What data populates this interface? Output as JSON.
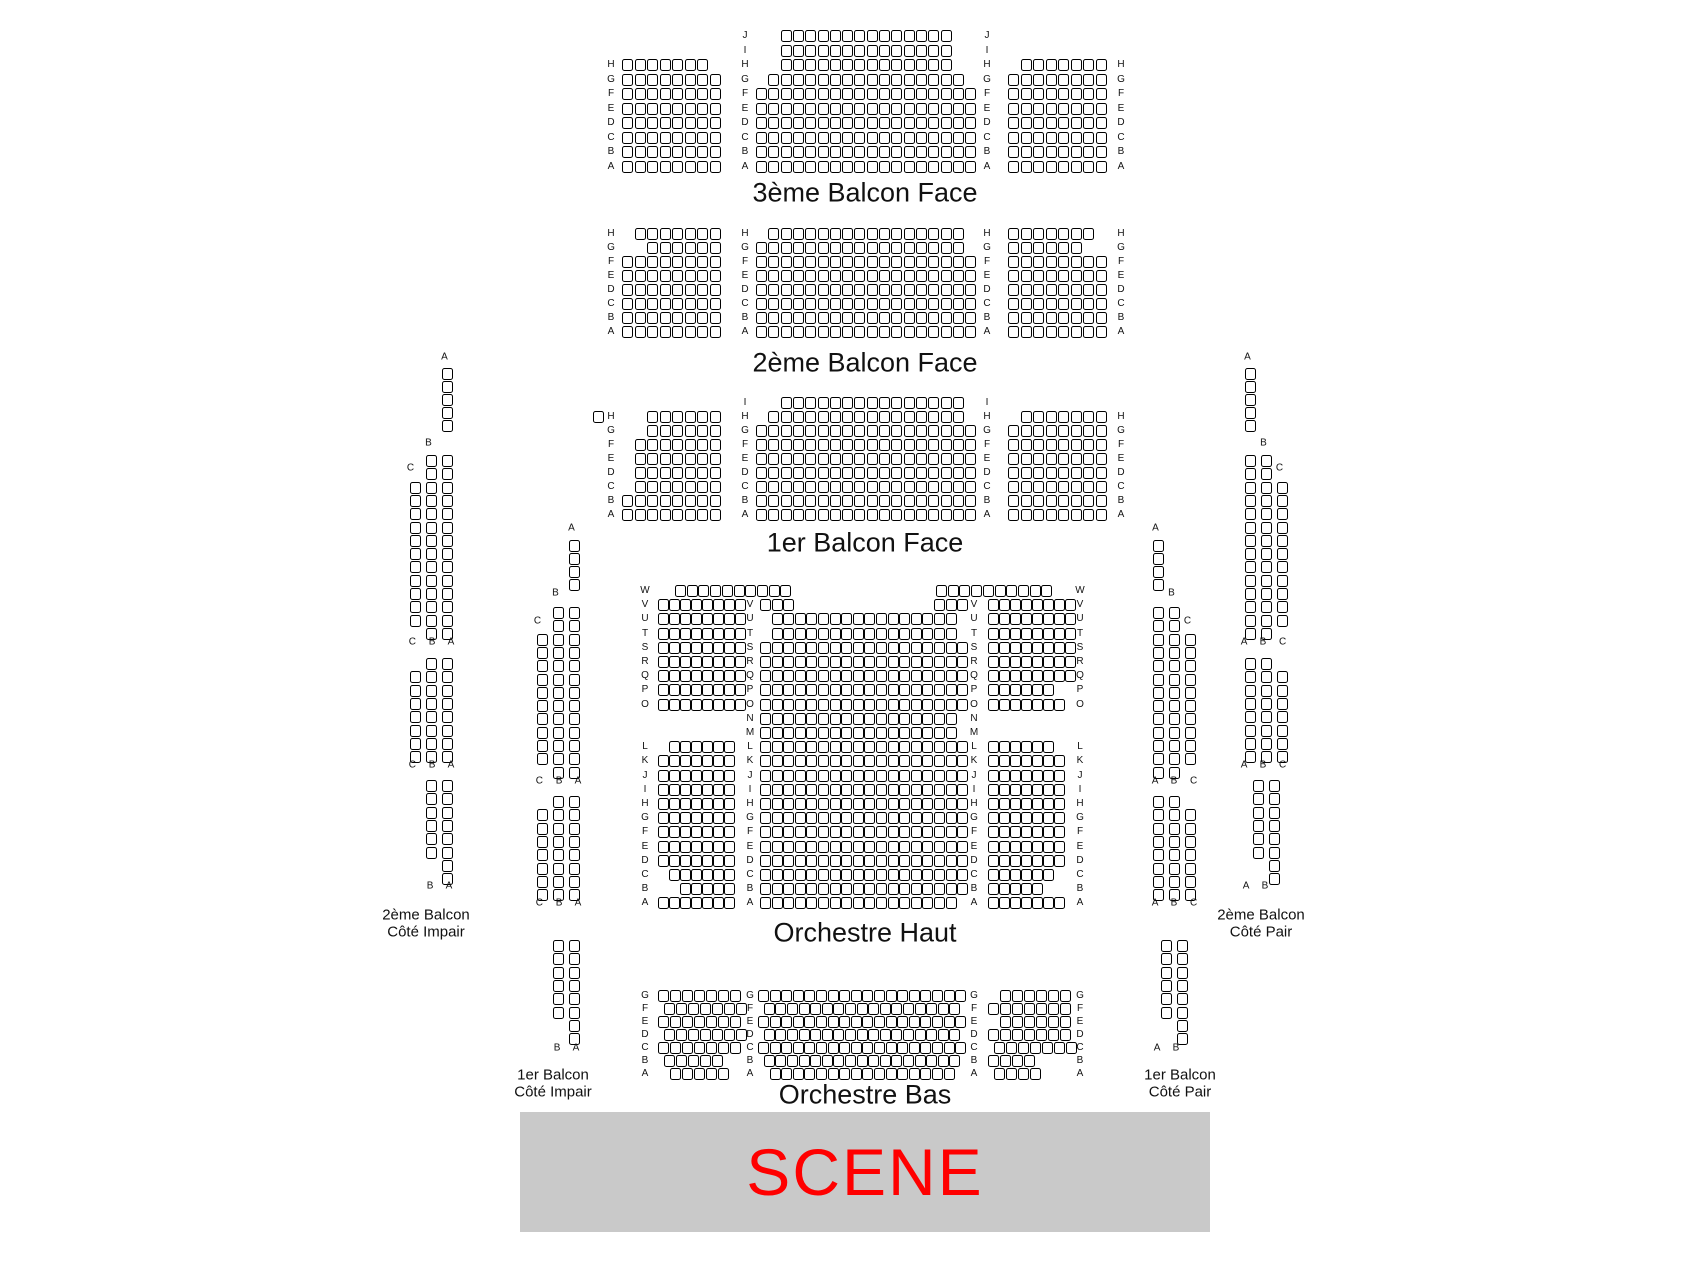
{
  "page": {
    "width": 1696,
    "height": 1272,
    "background": "#ffffff"
  },
  "stage": {
    "label": "SCENE",
    "x": 520,
    "y": 1112,
    "w": 690,
    "h": 120,
    "bg": "#c9c9c9",
    "color": "#ff0000"
  },
  "titles": [
    {
      "text": "3ème Balcon Face",
      "x": 865,
      "y": 193,
      "size": 27
    },
    {
      "text": "2ème Balcon Face",
      "x": 865,
      "y": 363,
      "size": 27
    },
    {
      "text": "1er Balcon Face",
      "x": 865,
      "y": 543,
      "size": 27
    },
    {
      "text": "Orchestre Haut",
      "x": 865,
      "y": 933,
      "size": 27
    },
    {
      "text": "Orchestre Bas",
      "x": 865,
      "y": 1095,
      "size": 27
    },
    {
      "text": "2ème Balcon",
      "x": 426,
      "y": 915,
      "size": 15
    },
    {
      "text": "Côté Impair",
      "x": 426,
      "y": 932,
      "size": 15
    },
    {
      "text": "1er Balcon",
      "x": 553,
      "y": 1075,
      "size": 15
    },
    {
      "text": "Côté Impair",
      "x": 553,
      "y": 1092,
      "size": 15
    },
    {
      "text": "1er Balcon",
      "x": 1180,
      "y": 1075,
      "size": 15
    },
    {
      "text": "Côté Pair",
      "x": 1180,
      "y": 1092,
      "size": 15
    },
    {
      "text": "2ème Balcon",
      "x": 1261,
      "y": 915,
      "size": 15
    },
    {
      "text": "Côté Pair",
      "x": 1261,
      "y": 932,
      "size": 15
    }
  ],
  "labels": [
    {
      "t": "A",
      "x": 447,
      "y": 357
    },
    {
      "t": "B",
      "x": 431,
      "y": 443
    },
    {
      "t": "C",
      "x": 413,
      "y": 468
    },
    {
      "t": "C B A",
      "x": 434,
      "y": 642
    },
    {
      "t": "C B A",
      "x": 434,
      "y": 765
    },
    {
      "t": "B A",
      "x": 442,
      "y": 886
    },
    {
      "t": "A",
      "x": 574,
      "y": 528
    },
    {
      "t": "B",
      "x": 558,
      "y": 593
    },
    {
      "t": "C",
      "x": 540,
      "y": 621
    },
    {
      "t": "C B A",
      "x": 561,
      "y": 781
    },
    {
      "t": "C B A",
      "x": 561,
      "y": 903
    },
    {
      "t": "B A",
      "x": 569,
      "y": 1048
    },
    {
      "t": "A",
      "x": 1158,
      "y": 528
    },
    {
      "t": "B",
      "x": 1174,
      "y": 593
    },
    {
      "t": "C",
      "x": 1190,
      "y": 621
    },
    {
      "t": "A B C",
      "x": 1177,
      "y": 781
    },
    {
      "t": "A B C",
      "x": 1177,
      "y": 903
    },
    {
      "t": "A B",
      "x": 1169,
      "y": 1048
    },
    {
      "t": "A",
      "x": 1250,
      "y": 357
    },
    {
      "t": "B",
      "x": 1266,
      "y": 443
    },
    {
      "t": "C",
      "x": 1282,
      "y": 468
    },
    {
      "t": "A B C",
      "x": 1266,
      "y": 642
    },
    {
      "t": "A B C",
      "x": 1266,
      "y": 765
    },
    {
      "t": "A B",
      "x": 1258,
      "y": 886
    }
  ],
  "label_columns": [
    {
      "x": 611,
      "y": 59,
      "py": 14.5,
      "letters": [
        "H",
        "G",
        "F",
        "E",
        "D",
        "C",
        "B",
        "A"
      ]
    },
    {
      "x": 745,
      "y": 30,
      "py": 14.5,
      "letters": [
        "J",
        "I",
        "H",
        "G",
        "F",
        "E",
        "D",
        "C",
        "B",
        "A"
      ]
    },
    {
      "x": 987,
      "y": 30,
      "py": 14.5,
      "letters": [
        "J",
        "I",
        "H",
        "G",
        "F",
        "E",
        "D",
        "C",
        "B",
        "A"
      ]
    },
    {
      "x": 1121,
      "y": 59,
      "py": 14.5,
      "letters": [
        "H",
        "G",
        "F",
        "E",
        "D",
        "C",
        "B",
        "A"
      ]
    },
    {
      "x": 611,
      "y": 228,
      "py": 14,
      "letters": [
        "H",
        "G",
        "F",
        "E",
        "D",
        "C",
        "B",
        "A"
      ]
    },
    {
      "x": 745,
      "y": 228,
      "py": 14,
      "letters": [
        "H",
        "G",
        "F",
        "E",
        "D",
        "C",
        "B",
        "A"
      ]
    },
    {
      "x": 987,
      "y": 228,
      "py": 14,
      "letters": [
        "H",
        "G",
        "F",
        "E",
        "D",
        "C",
        "B",
        "A"
      ]
    },
    {
      "x": 1121,
      "y": 228,
      "py": 14,
      "letters": [
        "H",
        "G",
        "F",
        "E",
        "D",
        "C",
        "B",
        "A"
      ]
    },
    {
      "x": 611,
      "y": 411,
      "py": 14,
      "letters": [
        "H",
        "G",
        "F",
        "E",
        "D",
        "C",
        "B",
        "A"
      ]
    },
    {
      "x": 745,
      "y": 397,
      "py": 14,
      "letters": [
        "I",
        "H",
        "G",
        "F",
        "E",
        "D",
        "C",
        "B",
        "A"
      ]
    },
    {
      "x": 987,
      "y": 397,
      "py": 14,
      "letters": [
        "I",
        "H",
        "G",
        "F",
        "E",
        "D",
        "C",
        "B",
        "A"
      ]
    },
    {
      "x": 1121,
      "y": 411,
      "py": 14,
      "letters": [
        "H",
        "G",
        "F",
        "E",
        "D",
        "C",
        "B",
        "A"
      ]
    },
    {
      "x": 645,
      "y": 585,
      "py": 14.2,
      "letters": [
        "W",
        "V",
        "U",
        "T",
        "S",
        "R",
        "Q",
        "P",
        "O",
        "",
        "",
        "L",
        "K",
        "J",
        "I",
        "H",
        "G",
        "F",
        "E",
        "D",
        "C",
        "B",
        "A"
      ]
    },
    {
      "x": 750,
      "y": 599.2,
      "py": 14.2,
      "letters": [
        "V",
        "U",
        "T",
        "S",
        "R",
        "Q",
        "P",
        "O",
        "N",
        "M",
        "L",
        "K",
        "J",
        "I",
        "H",
        "G",
        "F",
        "E",
        "D",
        "C",
        "B",
        "A"
      ]
    },
    {
      "x": 974,
      "y": 599.2,
      "py": 14.2,
      "letters": [
        "V",
        "U",
        "T",
        "S",
        "R",
        "Q",
        "P",
        "O",
        "N",
        "M",
        "L",
        "K",
        "J",
        "I",
        "H",
        "G",
        "F",
        "E",
        "D",
        "C",
        "B",
        "A"
      ]
    },
    {
      "x": 1080,
      "y": 585,
      "py": 14.2,
      "letters": [
        "W",
        "V",
        "U",
        "T",
        "S",
        "R",
        "Q",
        "P",
        "O",
        "",
        "",
        "L",
        "K",
        "J",
        "I",
        "H",
        "G",
        "F",
        "E",
        "D",
        "C",
        "B",
        "A"
      ]
    },
    {
      "x": 645,
      "y": 990,
      "py": 13,
      "letters": [
        "G",
        "F",
        "E",
        "D",
        "C",
        "B",
        "A"
      ]
    },
    {
      "x": 750,
      "y": 990,
      "py": 13,
      "letters": [
        "G",
        "F",
        "E",
        "D",
        "C",
        "B",
        "A"
      ]
    },
    {
      "x": 974,
      "y": 990,
      "py": 13,
      "letters": [
        "G",
        "F",
        "E",
        "D",
        "C",
        "B",
        "A"
      ]
    },
    {
      "x": 1080,
      "y": 990,
      "py": 13,
      "letters": [
        "G",
        "F",
        "E",
        "D",
        "C",
        "B",
        "A"
      ]
    }
  ],
  "seat_blocks": [
    {
      "x": 622,
      "y": 59,
      "px": 12.5,
      "py": 14.5,
      "rows": [
        7,
        8,
        8,
        8,
        8,
        8,
        8,
        8
      ]
    },
    {
      "x": 756,
      "y": 30,
      "px": 12.3,
      "py": 14.5,
      "rows": [
        [
          14,
          2
        ],
        [
          14,
          2
        ],
        [
          14,
          2
        ],
        [
          16,
          1
        ],
        18,
        18,
        18,
        18,
        18,
        18
      ]
    },
    {
      "x": 1008,
      "y": 59,
      "px": 12.5,
      "py": 14.5,
      "rows": [
        [
          7,
          1
        ],
        8,
        8,
        8,
        8,
        8,
        8,
        8
      ]
    },
    {
      "x": 622,
      "y": 228,
      "px": 12.5,
      "py": 14,
      "rows": [
        [
          7,
          1
        ],
        [
          6,
          2
        ],
        8,
        8,
        8,
        8,
        8,
        8
      ]
    },
    {
      "x": 756,
      "y": 228,
      "px": 12.3,
      "py": 14,
      "rows": [
        [
          16,
          1
        ],
        17,
        18,
        18,
        18,
        18,
        18,
        18
      ]
    },
    {
      "x": 1008,
      "y": 228,
      "px": 12.5,
      "py": 14,
      "rows": [
        7,
        6,
        8,
        8,
        8,
        8,
        8,
        8
      ]
    },
    {
      "x": 593,
      "y": 411,
      "px": 12.5,
      "py": 14,
      "rows": [
        1
      ]
    },
    {
      "x": 622,
      "y": 411,
      "px": 12.5,
      "py": 14,
      "rows": [
        [
          6,
          2
        ],
        [
          6,
          2
        ],
        [
          7,
          1
        ],
        [
          7,
          1
        ],
        [
          7,
          1
        ],
        [
          7,
          1
        ],
        8,
        8
      ]
    },
    {
      "x": 756,
      "y": 397,
      "px": 12.3,
      "py": 14,
      "rows": [
        [
          15,
          2
        ],
        [
          16,
          1
        ],
        18,
        18,
        18,
        18,
        18,
        18,
        18
      ]
    },
    {
      "x": 1008,
      "y": 411,
      "px": 12.5,
      "py": 14,
      "rows": [
        [
          7,
          1
        ],
        8,
        8,
        8,
        8,
        8,
        8,
        8
      ]
    },
    {
      "x": 675,
      "y": 585,
      "px": 11.7,
      "py": 14.2,
      "rows": [
        10
      ]
    },
    {
      "x": 936,
      "y": 585,
      "px": 11.7,
      "py": 14.2,
      "rows": [
        10
      ]
    },
    {
      "x": 760,
      "y": 599.2,
      "px": 11.6,
      "py": 14.2,
      "rows": [
        3
      ]
    },
    {
      "x": 934,
      "y": 599.2,
      "px": 11.6,
      "py": 14.2,
      "rows": [
        3
      ]
    },
    {
      "x": 658,
      "y": 599.2,
      "px": 11,
      "py": 14.2,
      "rows": [
        8,
        8,
        8,
        8,
        8,
        8,
        8,
        8,
        0,
        0,
        [
          6,
          1
        ],
        7,
        7,
        7,
        7,
        7,
        7,
        7,
        7,
        [
          6,
          1
        ],
        [
          5,
          2
        ],
        7
      ]
    },
    {
      "x": 760,
      "y": 613.4,
      "px": 11.6,
      "py": 14.2,
      "rows": [
        [
          16,
          1
        ],
        [
          16,
          1
        ],
        18,
        18,
        18,
        18,
        18,
        17,
        17,
        18,
        18,
        18,
        18,
        18,
        18,
        18,
        18,
        18,
        18,
        18,
        [
          17,
          0
        ]
      ]
    },
    {
      "x": 988,
      "y": 599.2,
      "px": 11,
      "py": 14.2,
      "rows": [
        8,
        8,
        8,
        8,
        8,
        8,
        6,
        7,
        0,
        0,
        6,
        7,
        7,
        7,
        7,
        7,
        7,
        7,
        7,
        6,
        5,
        7
      ]
    },
    {
      "x": 658,
      "y": 990,
      "px": 12,
      "py": 13,
      "rows": [
        7,
        [
          7,
          0.5
        ],
        7,
        [
          7,
          0.5
        ],
        7,
        [
          5,
          0.5
        ],
        [
          5,
          1
        ]
      ]
    },
    {
      "x": 758,
      "y": 990,
      "px": 11.6,
      "py": 13,
      "rows": [
        18,
        [
          17,
          0.5
        ],
        18,
        [
          17,
          0.5
        ],
        18,
        [
          17,
          0.5
        ],
        [
          16,
          1
        ]
      ]
    },
    {
      "x": 988,
      "y": 990,
      "px": 12,
      "py": 13,
      "rows": [
        [
          6,
          1
        ],
        7,
        [
          6,
          1
        ],
        7,
        [
          7,
          0.5
        ],
        4,
        [
          4,
          0.5
        ]
      ]
    },
    {
      "x": 442,
      "y": 368,
      "px": 16,
      "py": 13,
      "rows": [
        1,
        1,
        1,
        1,
        1
      ]
    },
    {
      "x": 410,
      "y": 455,
      "px": 16,
      "py": 13.3,
      "rows": [
        [
          2,
          1
        ],
        [
          2,
          1
        ],
        3,
        3,
        3,
        3,
        3,
        3,
        3,
        3,
        3,
        3,
        3,
        [
          2,
          1
        ]
      ]
    },
    {
      "x": 410,
      "y": 658,
      "px": 16,
      "py": 13.3,
      "rows": [
        [
          2,
          1
        ],
        3,
        3,
        3,
        3,
        3,
        3,
        3
      ]
    },
    {
      "x": 426,
      "y": 780,
      "px": 16,
      "py": 13.3,
      "rows": [
        2,
        2,
        2,
        2,
        2,
        2,
        [
          1,
          1
        ],
        [
          1,
          1
        ]
      ]
    },
    {
      "x": 569,
      "y": 540,
      "px": 16,
      "py": 13,
      "rows": [
        1,
        1,
        1,
        1
      ]
    },
    {
      "x": 537,
      "y": 607,
      "px": 16,
      "py": 13.3,
      "rows": [
        [
          2,
          1
        ],
        [
          2,
          1
        ],
        3,
        3,
        3,
        3,
        3,
        3,
        3,
        3,
        3,
        3,
        [
          2,
          1
        ]
      ]
    },
    {
      "x": 537,
      "y": 796,
      "px": 16,
      "py": 13.3,
      "rows": [
        [
          2,
          1
        ],
        3,
        3,
        3,
        3,
        3,
        3,
        3
      ]
    },
    {
      "x": 553,
      "y": 940,
      "px": 16,
      "py": 13.3,
      "rows": [
        2,
        2,
        2,
        2,
        2,
        2,
        [
          1,
          1
        ],
        [
          1,
          1
        ]
      ]
    },
    {
      "x": 1153,
      "y": 540,
      "px": 16,
      "py": 13,
      "rows": [
        1,
        1,
        1,
        1
      ]
    },
    {
      "x": 1153,
      "y": 607,
      "px": 16,
      "py": 13.3,
      "rows": [
        2,
        2,
        3,
        3,
        3,
        3,
        3,
        3,
        3,
        3,
        3,
        3,
        2
      ]
    },
    {
      "x": 1153,
      "y": 796,
      "px": 16,
      "py": 13.3,
      "rows": [
        2,
        3,
        3,
        3,
        3,
        3,
        3,
        3
      ]
    },
    {
      "x": 1161,
      "y": 940,
      "px": 16,
      "py": 13.3,
      "rows": [
        2,
        2,
        2,
        2,
        2,
        2,
        [
          1,
          1
        ],
        [
          1,
          1
        ]
      ]
    },
    {
      "x": 1245,
      "y": 368,
      "px": 16,
      "py": 13,
      "rows": [
        1,
        1,
        1,
        1,
        1
      ]
    },
    {
      "x": 1245,
      "y": 455,
      "px": 16,
      "py": 13.3,
      "rows": [
        2,
        2,
        3,
        3,
        3,
        3,
        3,
        3,
        3,
        3,
        3,
        3,
        3,
        2
      ]
    },
    {
      "x": 1245,
      "y": 658,
      "px": 16,
      "py": 13.3,
      "rows": [
        2,
        3,
        3,
        3,
        3,
        3,
        3,
        3
      ]
    },
    {
      "x": 1253,
      "y": 780,
      "px": 16,
      "py": 13.3,
      "rows": [
        2,
        2,
        2,
        2,
        2,
        2,
        [
          1,
          1
        ],
        [
          1,
          1
        ]
      ]
    }
  ]
}
